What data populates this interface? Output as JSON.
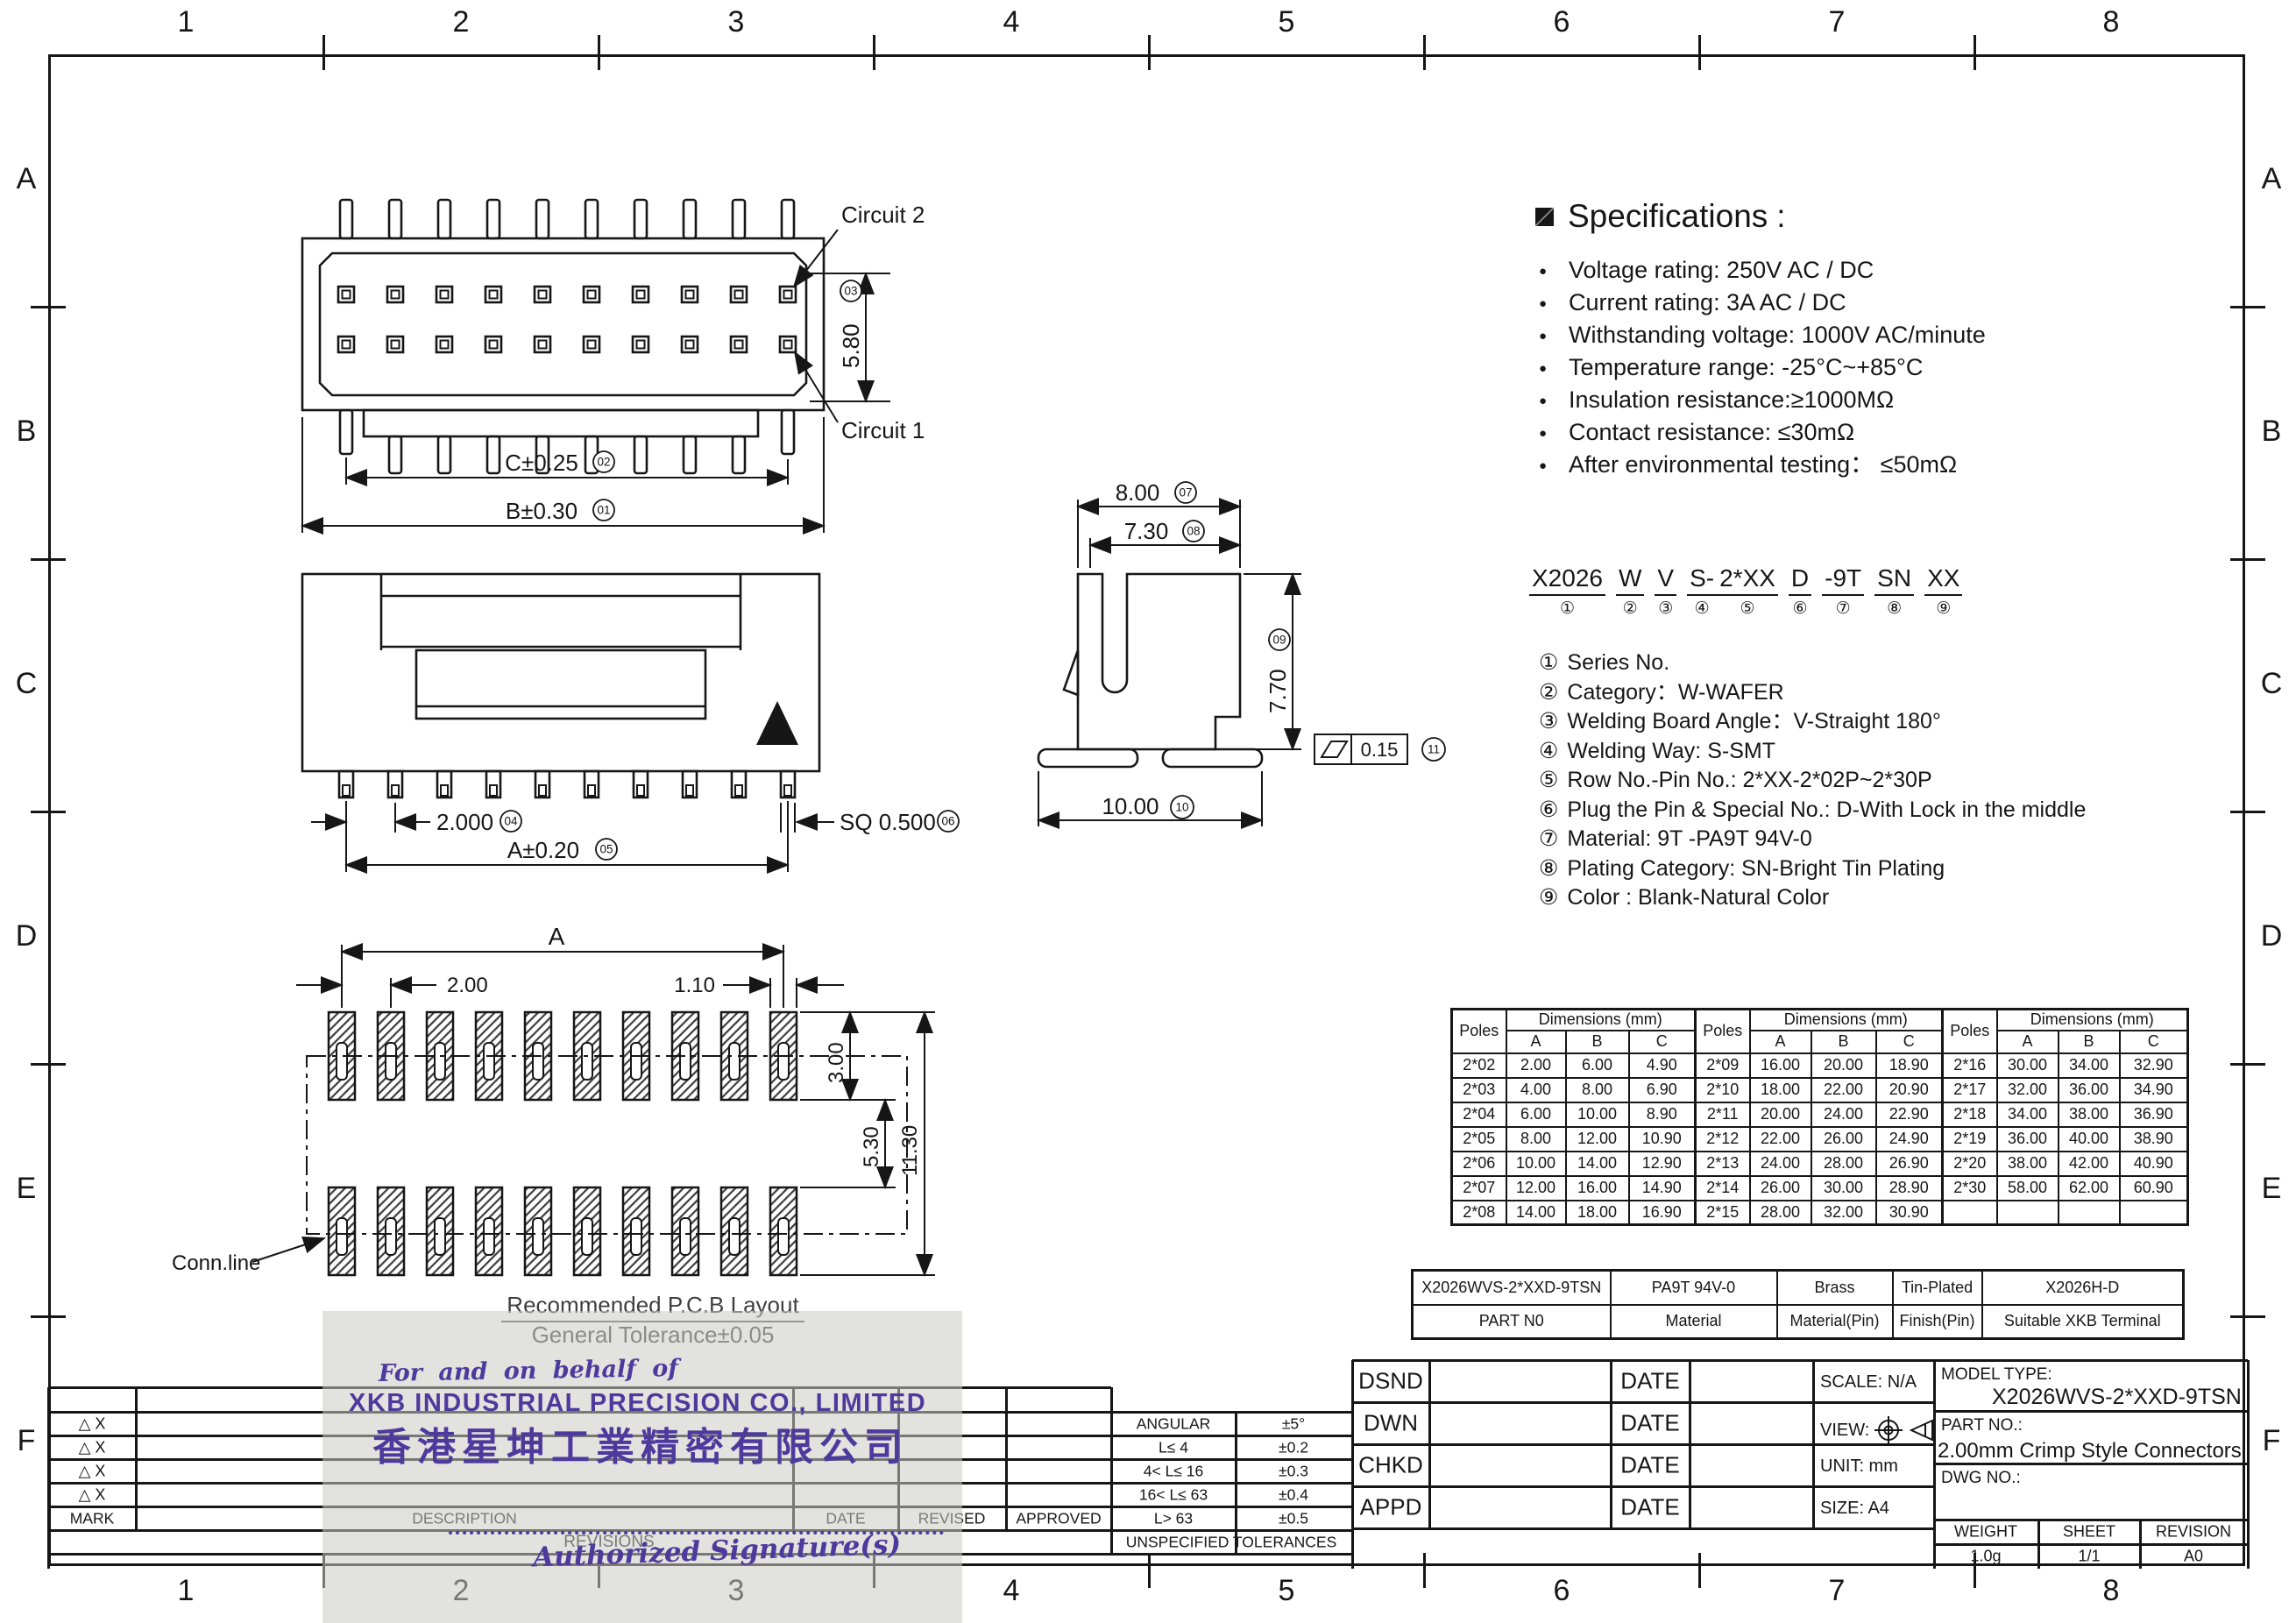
{
  "frame": {
    "cols": [
      "1",
      "2",
      "3",
      "4",
      "5",
      "6",
      "7",
      "8"
    ],
    "rows": [
      "A",
      "B",
      "C",
      "D",
      "E",
      "F"
    ]
  },
  "specs": {
    "title": "Specifications",
    "colon": ":",
    "items": [
      "Voltage rating: 250V AC / DC",
      "Current rating: 3A  AC / DC",
      "Withstanding voltage: 1000V AC/minute",
      "Temperature range: -25°C~+85°C",
      "Insulation resistance:≥1000MΩ",
      "Contact resistance: ≤30mΩ",
      "After environmental testing：  ≤50mΩ"
    ]
  },
  "part_code": {
    "groups": [
      {
        "t": "X2026",
        "n": "①"
      },
      {
        "t": "W",
        "n": "②"
      },
      {
        "t": "V",
        "n": "③"
      },
      {
        "t": "S-",
        "n": "④"
      },
      {
        "t": "2*XX",
        "n": "⑤",
        "tight": true
      },
      {
        "t": "D",
        "n": "⑥"
      },
      {
        "t": "-9T",
        "n": "⑦"
      },
      {
        "t": "SN",
        "n": "⑧"
      },
      {
        "t": "XX",
        "n": "⑨"
      }
    ]
  },
  "code_legend": {
    "items": [
      {
        "num": "①",
        "text": "Series No."
      },
      {
        "num": "②",
        "text": "Category：W-WAFER"
      },
      {
        "num": "③",
        "text": "Welding Board Angle：V-Straight 180°"
      },
      {
        "num": "④",
        "text": "Welding Way:  S-SMT"
      },
      {
        "num": "⑤",
        "text": "Row No.-Pin No.: 2*XX-2*02P~2*30P"
      },
      {
        "num": "⑥",
        "text": "Plug the Pin & Special No.:  D-With Lock in the middle"
      },
      {
        "num": "⑦",
        "text": "Material:  9T -PA9T  94V-0"
      },
      {
        "num": "⑧",
        "text": "Plating Category:  SN-Bright Tin Plating"
      },
      {
        "num": "⑨",
        "text": "Color :  Blank-Natural Color"
      }
    ]
  },
  "drawings": {
    "top_view": {
      "circuit2": "Circuit 2",
      "circuit1": "Circuit 1",
      "dim_c": "C±0.25",
      "ref_c": "02",
      "dim_b": "B±0.30",
      "ref_b": "01",
      "dim_h": "5.80",
      "ref_h": "03"
    },
    "front_view": {
      "dim_pitch": "2.000",
      "ref_pitch": "04",
      "dim_a": "A±0.20",
      "ref_a": "05",
      "dim_sq": "SQ 0.500",
      "ref_sq": "06"
    },
    "side_view": {
      "dim_top": "8.00",
      "ref_top": "07",
      "dim_inner": "7.30",
      "ref_inner": "08",
      "dim_height": "7.70",
      "ref_height": "09",
      "dim_bottom": "10.00",
      "ref_bottom": "10",
      "flatness": "0.15",
      "ref_flatness": "11"
    },
    "pcb": {
      "dim_a": "A",
      "dim_pitch": "2.00",
      "dim_pad": "1.10",
      "dim_len": "3.00",
      "dim_gap": "5.30",
      "dim_total": "11.30",
      "conn": "Conn.line",
      "title": "Recommended P.C.B Layout",
      "tol": "General Tolerance±0.05"
    }
  },
  "dims_table": {
    "poles_header": "Poles",
    "group_header": "Dimensions (mm)",
    "col_headers": [
      "A",
      "B",
      "C"
    ],
    "rows": [
      [
        "2*02",
        "2.00",
        "6.00",
        "4.90",
        "2*09",
        "16.00",
        "20.00",
        "18.90",
        "2*16",
        "30.00",
        "34.00",
        "32.90"
      ],
      [
        "2*03",
        "4.00",
        "8.00",
        "6.90",
        "2*10",
        "18.00",
        "22.00",
        "20.90",
        "2*17",
        "32.00",
        "36.00",
        "34.90"
      ],
      [
        "2*04",
        "6.00",
        "10.00",
        "8.90",
        "2*11",
        "20.00",
        "24.00",
        "22.90",
        "2*18",
        "34.00",
        "38.00",
        "36.90"
      ],
      [
        "2*05",
        "8.00",
        "12.00",
        "10.90",
        "2*12",
        "22.00",
        "26.00",
        "24.90",
        "2*19",
        "36.00",
        "40.00",
        "38.90"
      ],
      [
        "2*06",
        "10.00",
        "14.00",
        "12.90",
        "2*13",
        "24.00",
        "28.00",
        "26.90",
        "2*20",
        "38.00",
        "42.00",
        "40.90"
      ],
      [
        "2*07",
        "12.00",
        "16.00",
        "14.90",
        "2*14",
        "26.00",
        "30.00",
        "28.90",
        "2*30",
        "58.00",
        "62.00",
        "60.90"
      ],
      [
        "2*08",
        "14.00",
        "18.00",
        "16.90",
        "2*15",
        "28.00",
        "32.00",
        "30.90",
        "",
        "",
        "",
        ""
      ]
    ]
  },
  "parts_table": {
    "values": [
      "X2026WVS-2*XXD-9TSN",
      "PA9T  94V-0",
      "Brass",
      "Tin-Plated",
      "X2026H-D"
    ],
    "labels": [
      "PART N0",
      "Material",
      "Material(Pin)",
      "Finish(Pin)",
      "Suitable XKB Terminal"
    ]
  },
  "revisions": {
    "marks": [
      "△ X",
      "△ X",
      "△ X",
      "△ X"
    ],
    "mark_header": "MARK",
    "description_header": "DESCRIPTION",
    "date_header": "DATE",
    "revised_header": "REVISED",
    "approved_header": "APPROVED",
    "title": "REVISIONS"
  },
  "tolerances": {
    "rows": [
      [
        "ANGULAR",
        "±5°"
      ],
      [
        "L≤ 4",
        "±0.2"
      ],
      [
        "4< L≤ 16",
        "±0.3"
      ],
      [
        "16< L≤ 63",
        "±0.4"
      ],
      [
        "L> 63",
        "±0.5"
      ]
    ],
    "footer": "UNSPECIFIED  TOLERANCES"
  },
  "title_block": {
    "left_rows": [
      "DSND",
      "DWN",
      "CHKD",
      "APPD"
    ],
    "date_label": "DATE",
    "scale": "SCALE: N/A",
    "view_label": "VIEW:",
    "unit": "UNIT:  mm",
    "size": "SIZE:  A4",
    "model_type_label": "MODEL TYPE:",
    "model_type_value": "X2026WVS-2*XXD-9TSN",
    "part_no_label": "PART NO.:",
    "part_no_value": "2.00mm Crimp Style Connectors",
    "dwg_no_label": "DWG NO.:",
    "weight_label": "WEIGHT",
    "weight_value": "1.0g",
    "sheet_label": "SHEET",
    "sheet_value": "1/1",
    "revision_label": "REVISION",
    "revision_value": "A0"
  },
  "stamp": {
    "line1": "For and on behalf of",
    "line2": "XKB INDUSTRIAL PRECISION CO., LIMITED",
    "line3": "香港星坤工業精密有限公司",
    "line4": "Authorized Signature(s)"
  }
}
